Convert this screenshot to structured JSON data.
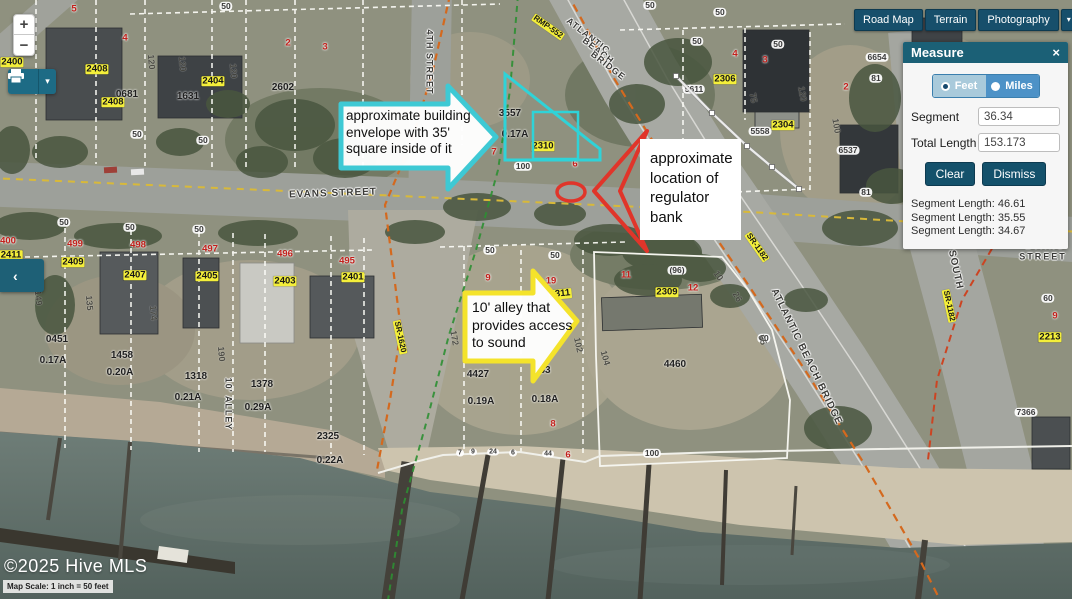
{
  "colors": {
    "ui_teal": "#174f6b",
    "panel_header": "#1b6076",
    "cyan_annotation": "#3ec9d4",
    "yellow_annotation": "#f4e32b",
    "red_annotation": "#e0352a",
    "yellow_label": "#f4ef3a",
    "red_label": "#c3201c"
  },
  "toolbar": {
    "basemaps": [
      "Road Map",
      "Terrain",
      "Photography"
    ],
    "dropdown_icon": "▾"
  },
  "zoom_controls": {
    "zoom_in": "+",
    "zoom_out": "−"
  },
  "print": {
    "dropdown_icon": "▾"
  },
  "side_tab": {
    "icon": "‹"
  },
  "measure": {
    "title": "Measure",
    "close_icon": "×",
    "units": [
      {
        "label": "Feet",
        "selected": true
      },
      {
        "label": "Miles",
        "selected": false
      }
    ],
    "segment_label": "Segment",
    "segment_value": "36.34",
    "total_label": "Total Length",
    "total_value": "153.173",
    "clear_label": "Clear",
    "dismiss_label": "Dismiss",
    "segment_lengths": [
      "Segment Length: 46.61",
      "Segment Length: 35.55",
      "Segment Length: 34.67"
    ]
  },
  "annotations": {
    "building_envelope": "approximate building\nenvelope with 35'\nsquare inside of it",
    "regulator": "approximate\nlocation of\nregulator\nbank",
    "alley": "10' alley that\nprovides access\nto sound"
  },
  "attribution": {
    "copyright": "©2025 Hive MLS",
    "scale": "Map Scale: 1 inch = 50 feet"
  },
  "map_labels": [
    {
      "t": "EVANS STREET",
      "x": 333,
      "y": 194,
      "c": "st",
      "r": -2,
      "ls": 1
    },
    {
      "t": "EVANS",
      "x": 1045,
      "y": 246,
      "c": "st",
      "fs": 9,
      "ls": 2
    },
    {
      "t": "STREET",
      "x": 1043,
      "y": 257,
      "c": "st",
      "fs": 9,
      "ls": 2
    },
    {
      "t": "ATLANTIC",
      "x": 588,
      "y": 36,
      "c": "st",
      "r": 38,
      "fs": 9
    },
    {
      "t": "BEACH",
      "x": 598,
      "y": 51,
      "c": "st",
      "r": 38,
      "fs": 9
    },
    {
      "t": "BRIDGE",
      "x": 608,
      "y": 66,
      "c": "st",
      "r": 38,
      "fs": 9
    },
    {
      "t": "ATLANTIC BEACH BRIDGE",
      "x": 806,
      "y": 357,
      "c": "st",
      "r": 64,
      "ls": 1
    },
    {
      "t": "SOUTH",
      "x": 955,
      "y": 270,
      "c": "st",
      "r": 78,
      "ls": 1
    },
    {
      "t": "4TH STREET",
      "x": 429,
      "y": 62,
      "c": "st",
      "r": 90,
      "fs": 9,
      "ls": 1
    },
    {
      "t": "10' ALLEY",
      "x": 228,
      "y": 404,
      "c": "st",
      "r": 90,
      "fs": 9
    },
    {
      "t": "RMP-552",
      "x": 548,
      "y": 27,
      "c": "yl",
      "r": 35,
      "fs": 8
    },
    {
      "t": "SR-1620",
      "x": 400,
      "y": 337,
      "c": "yl",
      "r": 78,
      "fs": 8
    },
    {
      "t": "SR-1182",
      "x": 757,
      "y": 247,
      "c": "yl",
      "r": 55,
      "fs": 8
    },
    {
      "t": "SR-1182",
      "x": 949,
      "y": 306,
      "c": "yl",
      "r": 78,
      "fs": 8
    },
    {
      "t": "2400",
      "x": 12,
      "y": 62,
      "c": "yl"
    },
    {
      "t": "2408",
      "x": 97,
      "y": 69,
      "c": "yl"
    },
    {
      "t": "2408",
      "x": 113,
      "y": 102,
      "c": "yl"
    },
    {
      "t": "2404",
      "x": 213,
      "y": 81,
      "c": "yl"
    },
    {
      "t": "2411",
      "x": 11,
      "y": 255,
      "c": "yl"
    },
    {
      "t": "2409",
      "x": 73,
      "y": 262,
      "c": "yl"
    },
    {
      "t": "2407",
      "x": 135,
      "y": 275,
      "c": "yl"
    },
    {
      "t": "2405",
      "x": 207,
      "y": 276,
      "c": "yl"
    },
    {
      "t": "2403",
      "x": 285,
      "y": 281,
      "c": "yl"
    },
    {
      "t": "2401",
      "x": 353,
      "y": 277,
      "c": "yl"
    },
    {
      "t": "2310",
      "x": 543,
      "y": 146,
      "c": "yl"
    },
    {
      "t": "2311",
      "x": 560,
      "y": 294,
      "c": "yl",
      "r": -6
    },
    {
      "t": "2309",
      "x": 667,
      "y": 292,
      "c": "yl"
    },
    {
      "t": "2306",
      "x": 725,
      "y": 79,
      "c": "yl"
    },
    {
      "t": "2304",
      "x": 783,
      "y": 125,
      "c": "yl"
    },
    {
      "t": "2213",
      "x": 1050,
      "y": 337,
      "c": "yl"
    },
    {
      "t": "5",
      "x": 74,
      "y": 9,
      "c": "rd"
    },
    {
      "t": "4",
      "x": 125,
      "y": 38,
      "c": "rd"
    },
    {
      "t": "3",
      "x": 325,
      "y": 47,
      "c": "rd"
    },
    {
      "t": "2",
      "x": 288,
      "y": 43,
      "c": "rd"
    },
    {
      "t": "4",
      "x": 735,
      "y": 54,
      "c": "rd"
    },
    {
      "t": "3",
      "x": 765,
      "y": 60,
      "c": "rd"
    },
    {
      "t": "2",
      "x": 846,
      "y": 87,
      "c": "rd"
    },
    {
      "t": "7",
      "x": 494,
      "y": 152,
      "c": "rd"
    },
    {
      "t": "6",
      "x": 575,
      "y": 164,
      "c": "rd"
    },
    {
      "t": "9",
      "x": 488,
      "y": 278,
      "c": "rd"
    },
    {
      "t": "19",
      "x": 551,
      "y": 281,
      "c": "rd"
    },
    {
      "t": "11",
      "x": 626,
      "y": 275,
      "c": "rd"
    },
    {
      "t": "12",
      "x": 693,
      "y": 288,
      "c": "rd"
    },
    {
      "t": "9",
      "x": 1055,
      "y": 316,
      "c": "rd"
    },
    {
      "t": "8",
      "x": 553,
      "y": 424,
      "c": "rd"
    },
    {
      "t": "6",
      "x": 568,
      "y": 455,
      "c": "rd"
    },
    {
      "t": "400",
      "x": 8,
      "y": 241,
      "c": "rd"
    },
    {
      "t": "499",
      "x": 75,
      "y": 244,
      "c": "rd"
    },
    {
      "t": "498",
      "x": 138,
      "y": 245,
      "c": "rd"
    },
    {
      "t": "497",
      "x": 210,
      "y": 249,
      "c": "rd"
    },
    {
      "t": "496",
      "x": 285,
      "y": 254,
      "c": "rd"
    },
    {
      "t": "495",
      "x": 347,
      "y": 261,
      "c": "rd"
    },
    {
      "t": "50",
      "x": 226,
      "y": 6,
      "c": "bx"
    },
    {
      "t": "50",
      "x": 650,
      "y": 5,
      "c": "bx"
    },
    {
      "t": "50",
      "x": 720,
      "y": 12,
      "c": "bx"
    },
    {
      "t": "50",
      "x": 697,
      "y": 41,
      "c": "bx"
    },
    {
      "t": "50",
      "x": 778,
      "y": 44,
      "c": "bx"
    },
    {
      "t": "50",
      "x": 137,
      "y": 134,
      "c": "bx"
    },
    {
      "t": "50",
      "x": 203,
      "y": 140,
      "c": "bx"
    },
    {
      "t": "50",
      "x": 64,
      "y": 222,
      "c": "bx"
    },
    {
      "t": "50",
      "x": 130,
      "y": 227,
      "c": "bx"
    },
    {
      "t": "50",
      "x": 199,
      "y": 229,
      "c": "bx"
    },
    {
      "t": "50",
      "x": 490,
      "y": 250,
      "c": "bx"
    },
    {
      "t": "50",
      "x": 555,
      "y": 255,
      "c": "bx"
    },
    {
      "t": "60",
      "x": 764,
      "y": 338,
      "c": "bx"
    },
    {
      "t": "60",
      "x": 1048,
      "y": 298,
      "c": "bx"
    },
    {
      "t": "100",
      "x": 523,
      "y": 166,
      "c": "bx"
    },
    {
      "t": "100",
      "x": 652,
      "y": 453,
      "c": "bx"
    },
    {
      "t": "(96)",
      "x": 677,
      "y": 270,
      "c": "bx"
    },
    {
      "t": "5611",
      "x": 694,
      "y": 89,
      "c": "bx"
    },
    {
      "t": "5558",
      "x": 760,
      "y": 131,
      "c": "bx"
    },
    {
      "t": "6654",
      "x": 877,
      "y": 57,
      "c": "bx"
    },
    {
      "t": "81",
      "x": 876,
      "y": 78,
      "c": "bx"
    },
    {
      "t": "6537",
      "x": 848,
      "y": 150,
      "c": "bx"
    },
    {
      "t": "81",
      "x": 866,
      "y": 192,
      "c": "bx"
    },
    {
      "t": "7366",
      "x": 1026,
      "y": 412,
      "c": "bx"
    },
    {
      "t": "7",
      "x": 460,
      "y": 453,
      "c": "bx",
      "fs": 7
    },
    {
      "t": "9",
      "x": 473,
      "y": 452,
      "c": "bx",
      "fs": 7
    },
    {
      "t": "24",
      "x": 493,
      "y": 452,
      "c": "bx",
      "fs": 7
    },
    {
      "t": "6",
      "x": 513,
      "y": 453,
      "c": "bx",
      "fs": 7
    },
    {
      "t": "44",
      "x": 548,
      "y": 454,
      "c": "bx",
      "fs": 7
    },
    {
      "t": "0681",
      "x": 127,
      "y": 95,
      "c": "dk"
    },
    {
      "t": "1631",
      "x": 188,
      "y": 97,
      "c": "dk"
    },
    {
      "t": "2602",
      "x": 283,
      "y": 88,
      "c": "dk"
    },
    {
      "t": "3557",
      "x": 510,
      "y": 114,
      "c": "dk"
    },
    {
      "t": "0.17A",
      "x": 515,
      "y": 135,
      "c": "dk"
    },
    {
      "t": "0451",
      "x": 57,
      "y": 340,
      "c": "dk"
    },
    {
      "t": "0.17A",
      "x": 53,
      "y": 361,
      "c": "dk"
    },
    {
      "t": "1458",
      "x": 122,
      "y": 356,
      "c": "dk"
    },
    {
      "t": "0.20A",
      "x": 120,
      "y": 373,
      "c": "dk"
    },
    {
      "t": "1318",
      "x": 196,
      "y": 377,
      "c": "dk"
    },
    {
      "t": "0.21A",
      "x": 188,
      "y": 398,
      "c": "dk"
    },
    {
      "t": "1378",
      "x": 262,
      "y": 385,
      "c": "dk"
    },
    {
      "t": "0.29A",
      "x": 258,
      "y": 408,
      "c": "dk"
    },
    {
      "t": "2325",
      "x": 328,
      "y": 437,
      "c": "dk"
    },
    {
      "t": "0.22A",
      "x": 330,
      "y": 461,
      "c": "dk"
    },
    {
      "t": "4427",
      "x": 478,
      "y": 375,
      "c": "dk"
    },
    {
      "t": "63",
      "x": 545,
      "y": 371,
      "c": "dk"
    },
    {
      "t": "0.19A",
      "x": 481,
      "y": 402,
      "c": "dk"
    },
    {
      "t": "0.18A",
      "x": 545,
      "y": 400,
      "c": "dk"
    },
    {
      "t": "4460",
      "x": 675,
      "y": 365,
      "c": "dk"
    },
    {
      "t": "120",
      "x": 151,
      "y": 62,
      "c": "dm",
      "r": 85
    },
    {
      "t": "120",
      "x": 182,
      "y": 64,
      "c": "dm",
      "r": 85
    },
    {
      "t": "120",
      "x": 233,
      "y": 71,
      "c": "dm",
      "r": 85
    },
    {
      "t": "75",
      "x": 753,
      "y": 98,
      "c": "dm",
      "r": 80
    },
    {
      "t": "120",
      "x": 802,
      "y": 94,
      "c": "dm",
      "r": 80
    },
    {
      "t": "100",
      "x": 836,
      "y": 126,
      "c": "dm",
      "r": 80
    },
    {
      "t": "149",
      "x": 38,
      "y": 298,
      "c": "dm",
      "r": 85
    },
    {
      "t": "135",
      "x": 89,
      "y": 303,
      "c": "dm",
      "r": 85
    },
    {
      "t": "174",
      "x": 153,
      "y": 313,
      "c": "dm",
      "r": 85
    },
    {
      "t": "190",
      "x": 221,
      "y": 354,
      "c": "dm",
      "r": 85
    },
    {
      "t": "172",
      "x": 454,
      "y": 338,
      "c": "dm",
      "r": 80
    },
    {
      "t": "102",
      "x": 578,
      "y": 345,
      "c": "dm",
      "r": 78
    },
    {
      "t": "104",
      "x": 605,
      "y": 358,
      "c": "dm",
      "r": 74
    },
    {
      "t": "10",
      "x": 718,
      "y": 276,
      "c": "dm",
      "r": 55
    },
    {
      "t": "26",
      "x": 737,
      "y": 297,
      "c": "dm",
      "r": 60
    },
    {
      "t": "55",
      "x": 762,
      "y": 340,
      "c": "dm",
      "r": 70
    }
  ]
}
